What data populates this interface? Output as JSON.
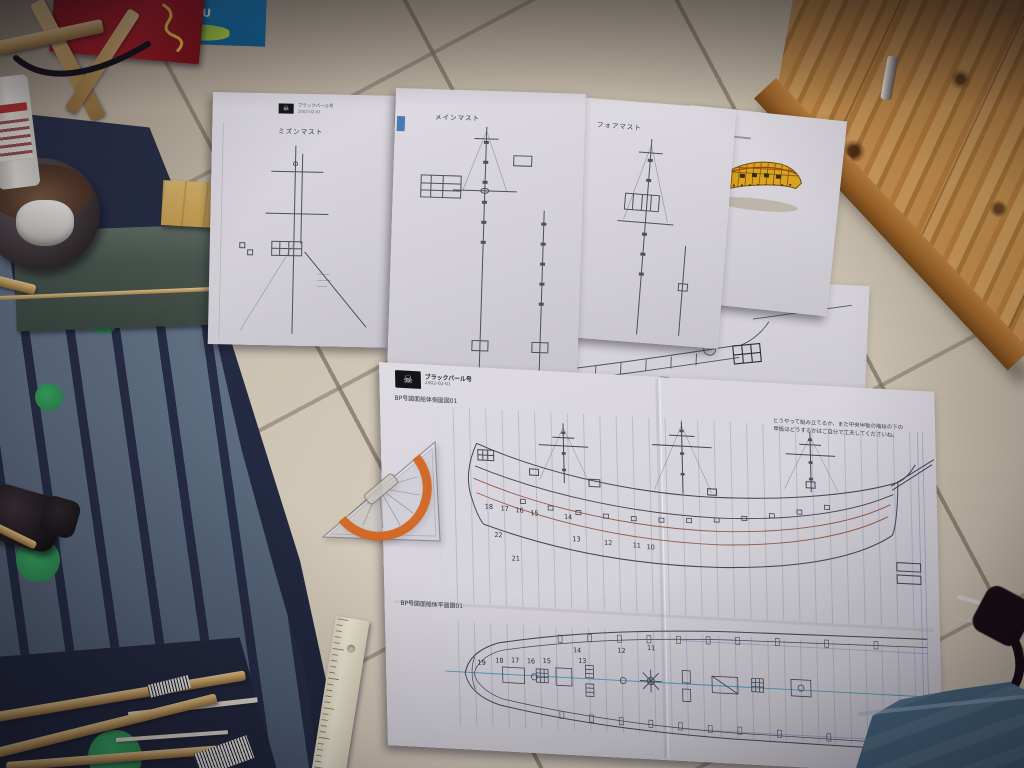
{
  "scene": {
    "description": "Photograph: Japanese model-ship blueprint sheets for the Black Pearl spread on a beige tiled floor beside a blue rug with green dots, a pine cabinet, a protractor set-square, rulers, wooden dowels, a power plug and denim fabric."
  },
  "blueprints": {
    "brand": "ブラックパール号",
    "date": "2002-02-01",
    "side_view_title": "BP号図面船体側面図01",
    "plan_view_title": "BP号図面船体平面図01",
    "mast_sheets": {
      "left": "ミズンマスト",
      "middle": "メインマスト",
      "right": "フォアマスト"
    },
    "note": "どうやって組み立てるか、また中央甲板の階段の下の甲板はどうするかはご自分で工夫してくださいね。",
    "side_frame_numbers": [
      "18",
      "17",
      "16",
      "15",
      "14",
      "13",
      "12",
      "11",
      "10"
    ],
    "side_stern_numbers": [
      "22",
      "21"
    ],
    "plan_frame_numbers": [
      "19",
      "18",
      "17",
      "16",
      "15",
      "14",
      "13",
      "12",
      "11"
    ]
  },
  "objects": {
    "bag_text": "ECOU",
    "skull_icon": "☠"
  },
  "colors": {
    "tile": "#cdc3b2",
    "grout": "#7d7261",
    "cabinet_wood": "#c68f4e",
    "molding": "#9a6228",
    "rug_dark": "#232940",
    "rug_light": "#6f7e92",
    "rug_green": "#2f9a55",
    "paper": "#d6d3d9",
    "construction_blue": "#5f82be",
    "drawing_dark": "#474753",
    "wale_red": "#96564a",
    "protractor_orange": "#d4641c",
    "hull_yellow": "#d9a31f",
    "denim": "#4e7089",
    "ruler_cream": "#e9e4cf"
  }
}
